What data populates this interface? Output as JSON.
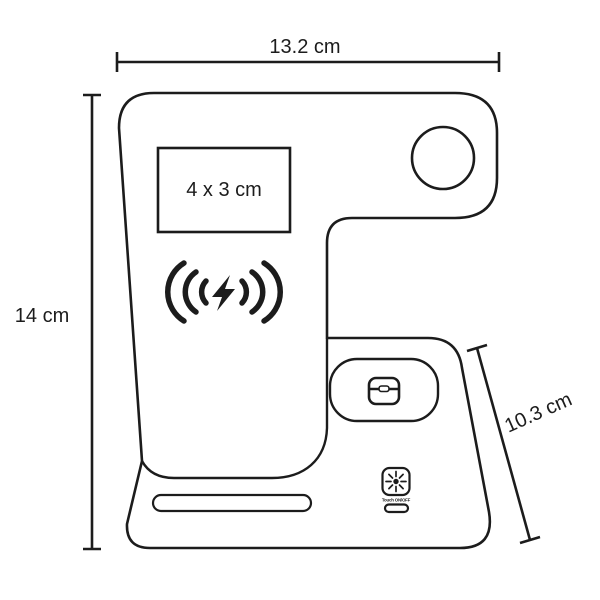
{
  "diagram": {
    "type": "product-dimension-drawing",
    "subject": "wireless-charging-stand",
    "background_color": "#ffffff",
    "line_color": "#1c1c1c",
    "dimensions": {
      "width": "13.2 cm",
      "height": "14 cm",
      "depth": "10.3 cm"
    },
    "print_area": {
      "label": "4  x 3 cm"
    },
    "touch_button": {
      "label": "Touch ON/OFF"
    },
    "icons": [
      "wireless-charging-icon",
      "lightning-bolt-icon",
      "earbuds-case-icon",
      "touch-power-icon",
      "watch-charger-circle"
    ]
  }
}
